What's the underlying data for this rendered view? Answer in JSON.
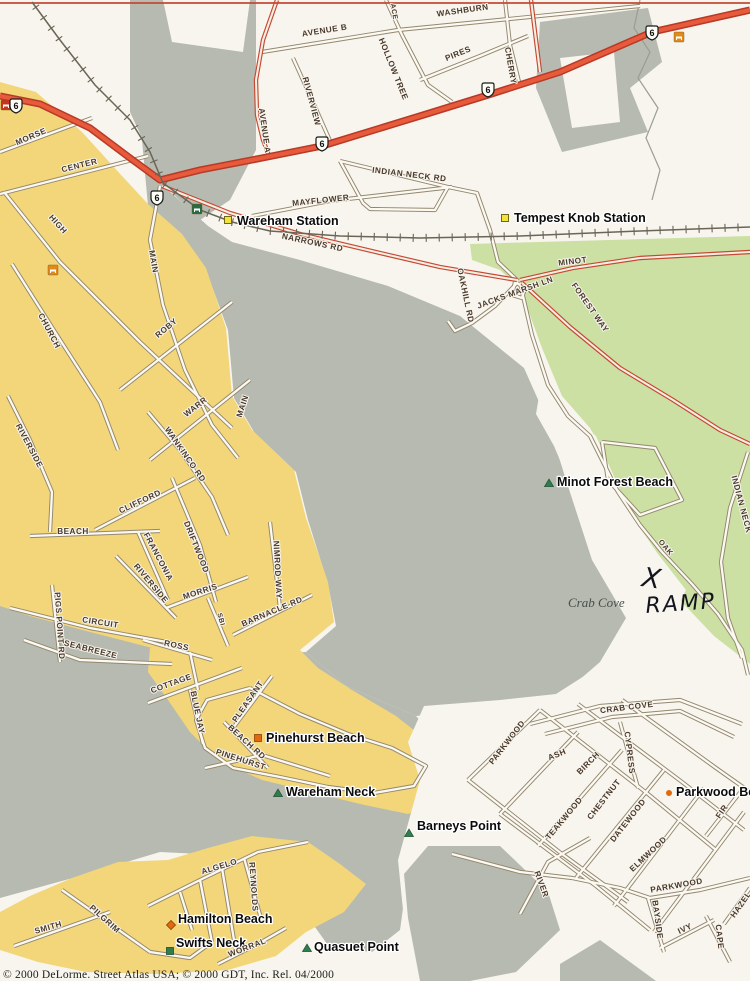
{
  "map": {
    "copyright": "© 2000 DeLorme.  Street Atlas USA; © 2000 GDT, Inc.  Rel. 04/2000",
    "colors": {
      "paper": "#f7f5ee",
      "water": "#b6bab0",
      "urban": "#f2d679",
      "forest": "#cbe0a2",
      "highway_fill": "#e85a3c",
      "highway_casing": "#b83a26",
      "secondary_casing": "#c64834",
      "street_casing": "#93876f",
      "street_fill": "#fbf9f1",
      "street_label": "#4a392b",
      "place_label": "#0b0b0b",
      "rail": "#6b6557"
    },
    "route_shields": [
      {
        "route": "6",
        "x": 16,
        "y": 106
      },
      {
        "route": "6",
        "x": 157,
        "y": 198
      },
      {
        "route": "6",
        "x": 322,
        "y": 144
      },
      {
        "route": "6",
        "x": 488,
        "y": 90
      },
      {
        "route": "6",
        "x": 652,
        "y": 33
      }
    ],
    "street_labels": [
      {
        "t": "WASHBURN",
        "x": 463,
        "y": 13,
        "r": -8
      },
      {
        "t": "AVENUE B",
        "x": 325,
        "y": 33,
        "r": -9
      },
      {
        "t": "ACE",
        "x": 392,
        "y": 12,
        "r": 80,
        "fs": 7
      },
      {
        "t": "HOLLOW TREE",
        "x": 391,
        "y": 70,
        "r": 68
      },
      {
        "t": "PIRES",
        "x": 459,
        "y": 56,
        "r": -22
      },
      {
        "t": "CHERRY",
        "x": 508,
        "y": 66,
        "r": 80
      },
      {
        "t": "RIVERVIEW",
        "x": 309,
        "y": 102,
        "r": 75
      },
      {
        "t": "AVENUE A",
        "x": 262,
        "y": 131,
        "r": 82
      },
      {
        "t": "MAYFLOWER",
        "x": 321,
        "y": 203,
        "r": -6
      },
      {
        "t": "INDIAN NECK RD",
        "x": 409,
        "y": 177,
        "r": 7
      },
      {
        "t": "NARROWS RD",
        "x": 312,
        "y": 245,
        "r": 12
      },
      {
        "t": "MINOT",
        "x": 573,
        "y": 264,
        "r": -7
      },
      {
        "t": "JACKS MARSH LN",
        "x": 516,
        "y": 295,
        "r": -20
      },
      {
        "t": "OAKHILL RD",
        "x": 463,
        "y": 296,
        "r": 78
      },
      {
        "t": "FOREST WAY",
        "x": 588,
        "y": 309,
        "r": 55
      },
      {
        "t": "OAK",
        "x": 664,
        "y": 549,
        "r": 50,
        "fs": 7.5
      },
      {
        "t": "INDIAN NECK",
        "x": 739,
        "y": 505,
        "r": 75
      },
      {
        "t": "MORSE",
        "x": 32,
        "y": 139,
        "r": -23
      },
      {
        "t": "CENTER",
        "x": 80,
        "y": 168,
        "r": -14
      },
      {
        "t": "HIGH",
        "x": 56,
        "y": 226,
        "r": 48
      },
      {
        "t": "CHURCH",
        "x": 47,
        "y": 332,
        "r": 62
      },
      {
        "t": "MAIN",
        "x": 151,
        "y": 262,
        "r": 80
      },
      {
        "t": "ROBY",
        "x": 168,
        "y": 330,
        "r": -40
      },
      {
        "t": "WARR",
        "x": 197,
        "y": 409,
        "r": -38
      },
      {
        "t": "MAIN",
        "x": 245,
        "y": 407,
        "r": -72
      },
      {
        "t": "WANKINCO RD",
        "x": 183,
        "y": 456,
        "r": 55
      },
      {
        "t": "RIVERSIDE",
        "x": 27,
        "y": 447,
        "r": 62
      },
      {
        "t": "CLIFFORD",
        "x": 141,
        "y": 504,
        "r": -25
      },
      {
        "t": "DRIFTWOOD",
        "x": 194,
        "y": 548,
        "r": 68
      },
      {
        "t": "BEACH",
        "x": 73,
        "y": 534,
        "r": 0
      },
      {
        "t": "FRANCONIA",
        "x": 156,
        "y": 558,
        "r": 62
      },
      {
        "t": "RIVERSIDE",
        "x": 149,
        "y": 585,
        "r": 50
      },
      {
        "t": "MORRIS",
        "x": 201,
        "y": 594,
        "r": -18
      },
      {
        "t": "NIMROD WAY",
        "x": 275,
        "y": 570,
        "r": 87
      },
      {
        "t": "BARNACLE RD",
        "x": 273,
        "y": 614,
        "r": -23
      },
      {
        "t": "SBI",
        "x": 219,
        "y": 620,
        "r": 75,
        "fs": 7
      },
      {
        "t": "CIRCUIT",
        "x": 100,
        "y": 625,
        "r": 9
      },
      {
        "t": "SEABREEZE",
        "x": 90,
        "y": 652,
        "r": 14
      },
      {
        "t": "PIGS POINT RD",
        "x": 57,
        "y": 626,
        "r": 86
      },
      {
        "t": "ROSS",
        "x": 176,
        "y": 648,
        "r": 12
      },
      {
        "t": "COTTAGE",
        "x": 172,
        "y": 686,
        "r": -20
      },
      {
        "t": "BLUE JAY",
        "x": 195,
        "y": 713,
        "r": 78
      },
      {
        "t": "PLEASANT",
        "x": 250,
        "y": 703,
        "r": -55
      },
      {
        "t": "BEACH RD",
        "x": 245,
        "y": 744,
        "r": 42
      },
      {
        "t": "PINEHURST",
        "x": 240,
        "y": 762,
        "r": 18
      },
      {
        "t": "SMITH",
        "x": 49,
        "y": 930,
        "r": -16
      },
      {
        "t": "PILGRIM",
        "x": 103,
        "y": 921,
        "r": 42
      },
      {
        "t": "ALGELO",
        "x": 220,
        "y": 869,
        "r": -17
      },
      {
        "t": "REYNOLDS",
        "x": 251,
        "y": 887,
        "r": 86
      },
      {
        "t": "WORRAL",
        "x": 248,
        "y": 950,
        "r": -21
      },
      {
        "t": "CRAB COVE",
        "x": 627,
        "y": 710,
        "r": -7
      },
      {
        "t": "PARKWOOD",
        "x": 509,
        "y": 744,
        "r": -52
      },
      {
        "t": "ASH",
        "x": 558,
        "y": 757,
        "r": -22
      },
      {
        "t": "BIRCH",
        "x": 590,
        "y": 765,
        "r": -45
      },
      {
        "t": "CYPRESS",
        "x": 627,
        "y": 753,
        "r": 83
      },
      {
        "t": "CHESTNUT",
        "x": 606,
        "y": 801,
        "r": -52
      },
      {
        "t": "TEAKWOOD",
        "x": 566,
        "y": 820,
        "r": -50
      },
      {
        "t": "DATEWOOD",
        "x": 630,
        "y": 822,
        "r": -52
      },
      {
        "t": "ELMWOOD",
        "x": 650,
        "y": 856,
        "r": -43
      },
      {
        "t": "FIR",
        "x": 724,
        "y": 813,
        "r": -55
      },
      {
        "t": "RIVER",
        "x": 539,
        "y": 885,
        "r": 70
      },
      {
        "t": "PARKWOOD",
        "x": 677,
        "y": 888,
        "r": -10
      },
      {
        "t": "BAYSIDE",
        "x": 655,
        "y": 920,
        "r": 82
      },
      {
        "t": "IVY",
        "x": 686,
        "y": 931,
        "r": -25
      },
      {
        "t": "CAPE",
        "x": 717,
        "y": 937,
        "r": 83
      },
      {
        "t": "HAZEL",
        "x": 743,
        "y": 906,
        "r": -55
      }
    ],
    "place_labels": [
      {
        "text": "Wareham Station",
        "x": 237,
        "y": 225,
        "marker": {
          "shape": "square-yellow",
          "x": 228,
          "y": 220
        }
      },
      {
        "text": "Tempest Knob Station",
        "x": 514,
        "y": 222,
        "marker": {
          "shape": "square-yellow",
          "x": 505,
          "y": 218
        }
      },
      {
        "text": "Minot Forest Beach",
        "x": 557,
        "y": 486,
        "marker": {
          "shape": "triangle-green",
          "x": 549,
          "y": 483
        }
      },
      {
        "text": "Pinehurst Beach",
        "x": 266,
        "y": 742,
        "marker": {
          "shape": "square-orange",
          "x": 258,
          "y": 738
        }
      },
      {
        "text": "Wareham Neck",
        "x": 286,
        "y": 796,
        "marker": {
          "shape": "triangle-green",
          "x": 278,
          "y": 793
        }
      },
      {
        "text": "Hamilton Beach",
        "x": 178,
        "y": 923,
        "marker": {
          "shape": "diamond-orange",
          "x": 171,
          "y": 925
        }
      },
      {
        "text": "Swifts Neck",
        "x": 176,
        "y": 947,
        "marker": {
          "shape": "square-green",
          "x": 170,
          "y": 951
        }
      },
      {
        "text": "Quasuet Point",
        "x": 314,
        "y": 951,
        "marker": {
          "shape": "triangle-green",
          "x": 307,
          "y": 948
        }
      },
      {
        "text": "Barneys Point",
        "x": 417,
        "y": 830,
        "marker": {
          "shape": "triangle-green",
          "x": 409,
          "y": 833
        }
      },
      {
        "text": "Parkwood Beach",
        "x": 676,
        "y": 796,
        "marker": {
          "shape": "dot-orange",
          "x": 669,
          "y": 793
        }
      }
    ],
    "water_labels": [
      {
        "text": "Crab Cove",
        "x": 568,
        "y": 607
      }
    ],
    "handwritten_annotation": {
      "mark": "X",
      "mark_x": 641,
      "mark_y": 586,
      "word": "RAMP",
      "word_x": 646,
      "word_y": 613,
      "underline": [
        643,
        623,
        717,
        618
      ]
    },
    "poi_icons": [
      {
        "name": "poi-icon-red",
        "x": 6,
        "y": 105,
        "color": "#c9341f"
      },
      {
        "name": "picnic-area-icon",
        "x": 197,
        "y": 209,
        "color": "#2a6b47"
      },
      {
        "name": "lodging-icon",
        "x": 53,
        "y": 270,
        "color": "#e08a1e"
      },
      {
        "name": "rest-area-icon",
        "x": 679,
        "y": 37,
        "color": "#e08a1e"
      }
    ]
  }
}
